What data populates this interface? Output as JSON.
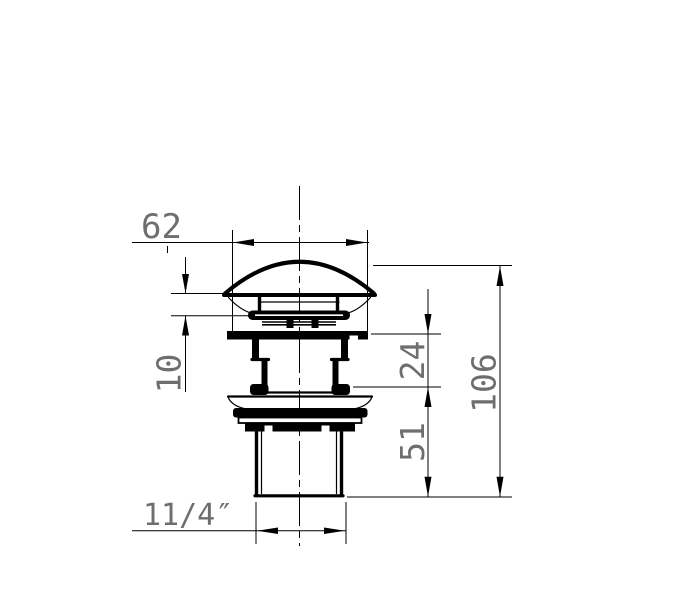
{
  "drawing": {
    "colors": {
      "background": "#ffffff",
      "lines": "#000000",
      "dimension_text": "#6e6e6e"
    },
    "dimensions": {
      "cap_width": {
        "label": "62"
      },
      "cap_lift": {
        "label": "10"
      },
      "body_depth": {
        "label": "24"
      },
      "thread_length": {
        "label": "51"
      },
      "overall_height": {
        "label": "106"
      },
      "thread_size": {
        "label": "11/4″"
      }
    }
  }
}
